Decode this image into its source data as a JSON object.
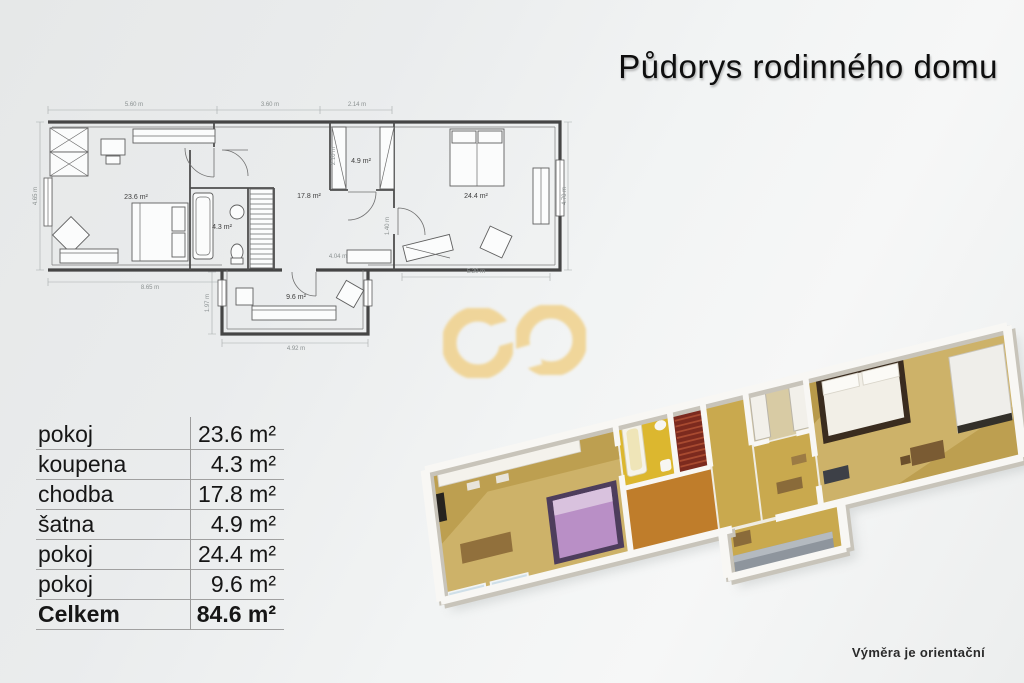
{
  "title": "Půdorys rodinného domu",
  "footnote": "Výměra je orientační",
  "area_table": {
    "rows": [
      {
        "label": "pokoj",
        "value": "23.6 m²"
      },
      {
        "label": "koupena",
        "value": "4.3 m²"
      },
      {
        "label": "chodba",
        "value": "17.8 m²"
      },
      {
        "label": "šatna",
        "value": "4.9 m²"
      },
      {
        "label": "pokoj",
        "value": "24.4 m²"
      },
      {
        "label": "pokoj",
        "value": "9.6 m²"
      }
    ],
    "total": {
      "label": "Celkem",
      "value": "84.6 m²"
    }
  },
  "floorplan_2d": {
    "rooms": {
      "living": "23.6 m²",
      "bath": "4.3 m²",
      "hall": "17.8 m²",
      "closet": "4.9 m²",
      "bedroom": "24.4 m²",
      "small": "9.6 m²"
    },
    "dims": {
      "top_a": "5.60 m",
      "top_b": "3.60 m",
      "top_c": "2.14 m",
      "left": "4.65 m",
      "right": "4.70 m",
      "bottom_a": "8.65 m",
      "bottom_b": "4.92 m",
      "bottom_c": "5.20 m",
      "side_small": "1.97 m",
      "inner_a": "4.04 m",
      "inner_b": "1.40 m",
      "inner_c": "2.10 m"
    }
  },
  "colors": {
    "watermark_gold": "#f0d28e",
    "floor_tan": "#cdb269",
    "floor_gold": "#dcb72f",
    "floor_orange": "#bf7d2b",
    "stairs_red": "#7c2a1e",
    "bed_purple": "#b98fc6",
    "sofa_gray": "#8e959d"
  }
}
